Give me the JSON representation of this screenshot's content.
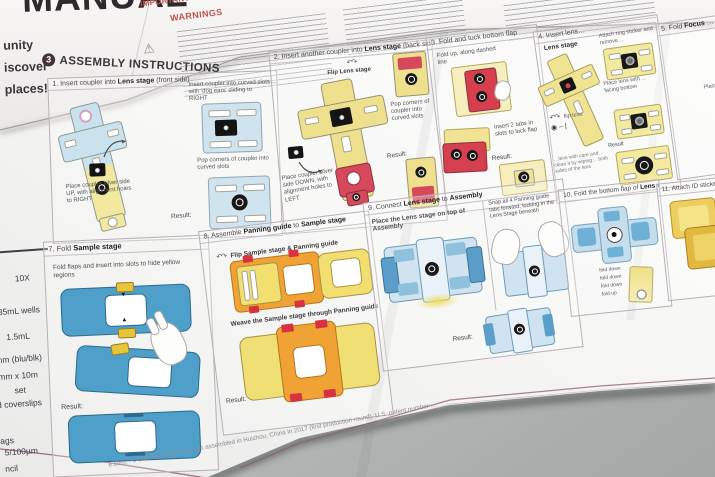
{
  "photo": {
    "desk_color": "#b7bab9",
    "paper_color": "#f8f8f6",
    "accent_maroon": "#8a5c72",
    "warning_red": "#c0544e",
    "badge_color": "#46313d",
    "diagram_blue": "#4e9fca",
    "diagram_light_blue": "#c9e2ee",
    "diagram_yellow": "#f0e08a",
    "diagram_orange": "#f0a235",
    "diagram_red": "#d6495c",
    "diagram_gold": "#e8c84a"
  },
  "masthead": {
    "title": "MANUAL",
    "taglines": [
      "unity",
      "iscover",
      "places!"
    ]
  },
  "warnings": {
    "kicker": "IMPORTANT S",
    "heading": "WARNINGS",
    "icon": "warning-triangle"
  },
  "section": {
    "badge": "3",
    "title": "ASSEMBLY INSTRUCTIONS"
  },
  "kit_list": {
    "items": [
      "10X",
      "35mL wells",
      "1.5mL",
      "mm (blu/blk)",
      "mm x 10m",
      "set",
      "nd coverslips",
      "ags",
      "5/100µm",
      "ncil"
    ]
  },
  "steps": {
    "s1": {
      "num": "1.",
      "t1": "Insert coupler into ",
      "b1": "Lens stage",
      "t2": " (front side)",
      "note_insert": "Insert coupler into curved slots with 'dog ears' sliding to RIGHT",
      "note_pop": "Pop corners of coupler into curved slots",
      "note_place": "Place coupler silver side UP, with alignment holes to RIGHT",
      "result": "Result:"
    },
    "s2": {
      "num": "2.",
      "t1": "Insert another coupler into ",
      "b1": "Lens stage",
      "t2": " (back side)",
      "flip_note": "Flip Lens stage",
      "note_place": "Place coupler silver side DOWN, with alignment holes to LEFT",
      "note_pop": "Pop corners of coupler into curved slots",
      "result": "Result:"
    },
    "s3": {
      "num": "3.",
      "t1": "Fold and tuck bottom flap",
      "note_fold": "Fold up, along dashed line",
      "note_tabs": "Insert 2 tabs in slots to lock flap",
      "result": "Result:"
    },
    "s4": {
      "num": "4.",
      "t1": "Insert lens…",
      "label": "Lens stage",
      "note_ring": "Attach ring sticker and remove…",
      "note_lens": "Place lens with … facing bottom",
      "note_flip": "flip lens",
      "glyphs": "◉ – |",
      "result": "Result",
      "note_care": "…lens with care and… clean it by wiping… both sides of the lens"
    },
    "s5": {
      "num": "5.",
      "t1": "Fold ",
      "b1": "Focus",
      "t2": " …",
      "note": "Place…"
    },
    "s7": {
      "num": "7.",
      "t1": "Fold ",
      "b1": "Sample stage",
      "note": "Fold flaps and insert into slots to hide yellow regions",
      "result": "Result:"
    },
    "s8": {
      "num": "8.",
      "t1": "Assemble ",
      "b1": "Panning guide",
      "t2": " to ",
      "b2": "Sample stage",
      "note_flip": "Flip Sample stage & Panning guide",
      "note_weave": "Weave the Sample stage through Panning guide",
      "result": "Result:"
    },
    "s9": {
      "num": "9.",
      "t1": "Connect ",
      "b1": "Lens stage",
      "t2": " to ",
      "b2": "Assembly",
      "note_place": "Place the Lens stage on top of Assembly",
      "note_snap": "Snap all 4 Panning guide tabs forward, locking in the Lens Stage beneath",
      "result": "Result:"
    },
    "s10": {
      "num": "10.",
      "t1": "Fold the bottom flap of ",
      "b1": "Lens stage",
      "labels": [
        "fold down",
        "fold down",
        "fold down",
        "fold up"
      ]
    },
    "s11": {
      "num": "11.",
      "t1": "Attach ID sticker…"
    }
  },
  "footer": {
    "fine_print": "e.com, +1-628-400-3653) and was assembled in Huizhou, China in 2017 (first production round). U.S. patent number …"
  }
}
